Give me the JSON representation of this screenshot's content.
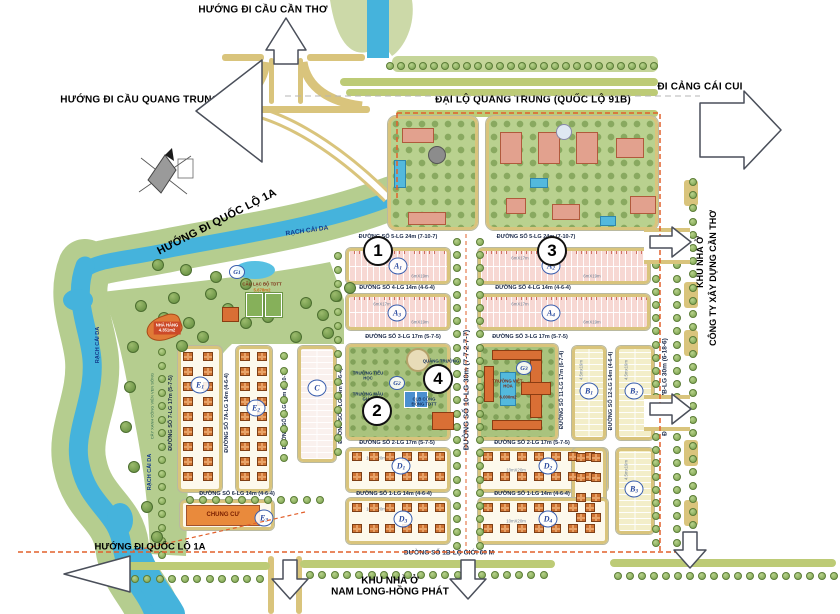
{
  "directions": {
    "north_bridge": "HƯỚNG ĐI CẦU CẦN THƠ",
    "west_bridge": "HƯỚNG ĐI CẦU QUANG TRUNG",
    "highway": "ĐẠI LỘ QUANG TRUNG (QUỐC LỘ 91B)",
    "port": "ĐI CẢNG CÁI CUI",
    "nh1a_top": "HƯỚNG ĐI QUỐC LỘ 1A",
    "nh1a_bottom": "HƯỚNG ĐI QUỐC LỘ 1A"
  },
  "neighbors": {
    "east_line1": "KHU NHÀ Ở",
    "east_line2": "CÔNG TY XÂY DỰNG CẦN THƠ",
    "south_line1": "KHU NHÀ Ở",
    "south_line2": "NAM LONG-HỒNG PHÁT"
  },
  "river": {
    "name": "RẠCH CÁI DA"
  },
  "park_strip": "CÂY XANH CÔNG VIÊN VEN SÔNG",
  "roads": {
    "s1": "ĐƯỜNG SỐ 1-LG 14m (4-6-4)",
    "s1b": "ĐƯỜNG SỐ 1B-LỘ GIỚI 60 M",
    "s2": "ĐƯỜNG SỐ 2-LG 17m (5-7-5)",
    "s3": "ĐƯỜNG SỐ 3-LG 17m (5-7-5)",
    "s4": "ĐƯỜNG SỐ 4-LG 14m (4-6-4)",
    "s5": "ĐƯỜNG SỐ 5-LG 24m (7-10-7)",
    "s6": "ĐƯỜNG SỐ 6-LG 14m (4-6-4)",
    "s7": "ĐƯỜNG SỐ 7-LG 17m (5-7-5)",
    "s7a": "ĐƯỜNG SỐ 7A-LG 14m (4-6-4)",
    "s7b": "ĐƯỜNG SỐ 7B-LG 30m (6-18-6)",
    "s9": "ĐƯỜNG SỐ 9-LG 14m (4-6-4)",
    "s10": "ĐƯỜNG SỐ 10-LG 30m (7-7-2-7-7)",
    "s11": "ĐƯỜNG SỐ 11-LG 17m (6-7-4)",
    "s12": "ĐƯỜNG SỐ 12-LG 14m (4-6-4)"
  },
  "zones": {
    "z1": "1",
    "z2": "2",
    "z3": "3",
    "z4": "4"
  },
  "blocks": {
    "a1": {
      "letter": "A",
      "idx": "1"
    },
    "a2": {
      "letter": "A",
      "idx": "2"
    },
    "a3": {
      "letter": "A",
      "idx": "3"
    },
    "a4": {
      "letter": "A",
      "idx": "4"
    },
    "b1": {
      "letter": "B",
      "idx": "1"
    },
    "b2": {
      "letter": "B",
      "idx": "2"
    },
    "b3": {
      "letter": "B",
      "idx": "3"
    },
    "c": {
      "letter": "C",
      "idx": ""
    },
    "d1": {
      "letter": "D",
      "idx": "1"
    },
    "d2": {
      "letter": "D",
      "idx": "2"
    },
    "d3": {
      "letter": "D",
      "idx": "3"
    },
    "d4": {
      "letter": "D",
      "idx": "4"
    },
    "e1": {
      "letter": "E",
      "idx": "1"
    },
    "e2": {
      "letter": "E",
      "idx": "2"
    },
    "e3": {
      "letter": "E",
      "idx": "3"
    }
  },
  "facilities": {
    "g1": {
      "letter": "G",
      "idx": "1"
    },
    "g2": {
      "letter": "G",
      "idx": "2"
    },
    "g3": {
      "letter": "G",
      "idx": "3"
    },
    "g1_name": "CÂU LẠC BỘ TDTT",
    "g1_area": "5.678m2",
    "restaurant": "NHÀ HÀNG",
    "restaurant_area": "4.351m2",
    "apartment": "CHUNG CƯ",
    "primary_school": "TRƯỜNG TIỂU HỌC",
    "kindergarten": "TRƯỜNG MẪU GIÁO",
    "plaza": "QUẢNG TRƯỜNG",
    "community_club": "CLB CỘNG ĐỒNG TDTT",
    "school_vh_name": "TRƯỜNG VIỆT-HOA",
    "school_vh_area": "6.000m2"
  },
  "lot_sizes": {
    "a_upper": "6mX17m",
    "a_lower": "6mX19m",
    "b": "4.5mx19m",
    "d": "10mX20m"
  },
  "colors": {
    "river": "#45b3dc",
    "park": "#b5cd8f",
    "road_edge": "#d9c47c",
    "lot_pink": "#f7d8d3",
    "lot_yellow": "#f3eec9",
    "house": "#cf7434",
    "boundary": "#e2602c"
  }
}
